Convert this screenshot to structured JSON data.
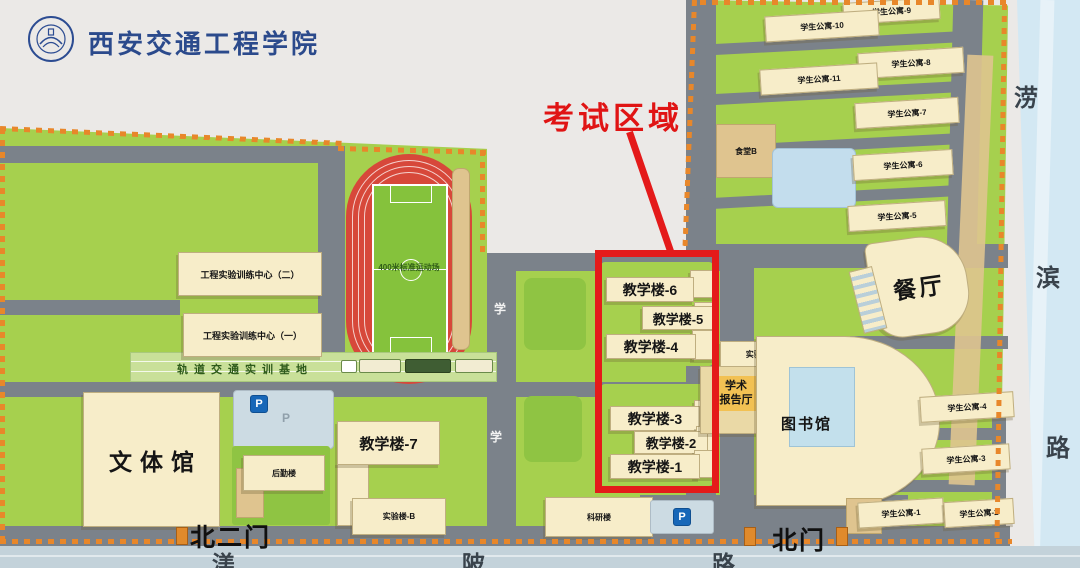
{
  "title": {
    "school_name": "西安交通工程学院"
  },
  "annotations": {
    "exam_area": "考试区域"
  },
  "gates": {
    "north_gate2": "北二门",
    "north_gate": "北门"
  },
  "roads": {
    "south_road": [
      "渼",
      "陂",
      "路"
    ],
    "east_road": [
      "涝",
      "滨",
      "路"
    ],
    "campus_road_char1": "学",
    "campus_road_char2": "学"
  },
  "stadium": {
    "track_label": "400米标准运动场",
    "rail_base": "轨道交通实训基地"
  },
  "buildings_left": {
    "training_center_2": "工程实验训练中心（二）",
    "training_center_1": "工程实验训练中心（一）",
    "sports_hall": "文体馆",
    "logistics": "后勤楼",
    "teaching_7": "教学楼-7",
    "lab_b": "实验楼-B",
    "research": "科研楼"
  },
  "exam_zone": {
    "t6": "教学楼-6",
    "t5": "教学楼-5",
    "t4": "教学楼-4",
    "t3": "教学楼-3",
    "t2": "教学楼-2",
    "t1": "教学楼-1"
  },
  "center_buildings": {
    "lab_a": "实验楼-A",
    "lecture_hall_line1": "学术",
    "lecture_hall_line2": "报告厅",
    "library": "图书馆"
  },
  "right_zone": {
    "canteen_b": "食堂B",
    "dining_hall": "餐厅",
    "apartments": {
      "a1": "学生公寓-1",
      "a2": "学生公寓-2",
      "a3": "学生公寓-3",
      "a4": "学生公寓-4",
      "a5": "学生公寓-5",
      "a6": "学生公寓-6",
      "a7": "学生公寓-7",
      "a8": "学生公寓-8",
      "a9": "学生公寓-9",
      "a10": "学生公寓-10",
      "a11": "学生公寓-11"
    }
  },
  "parking": {
    "p": "P"
  },
  "colors": {
    "campus_green": "#a6d04e",
    "road_gray": "#7b828a",
    "boundary_orange": "#e8872a",
    "exam_red": "#e41a1a",
    "building_cream": "#f7edc9",
    "river_blue": "#d3e8f3",
    "track_red": "#d7483a"
  }
}
